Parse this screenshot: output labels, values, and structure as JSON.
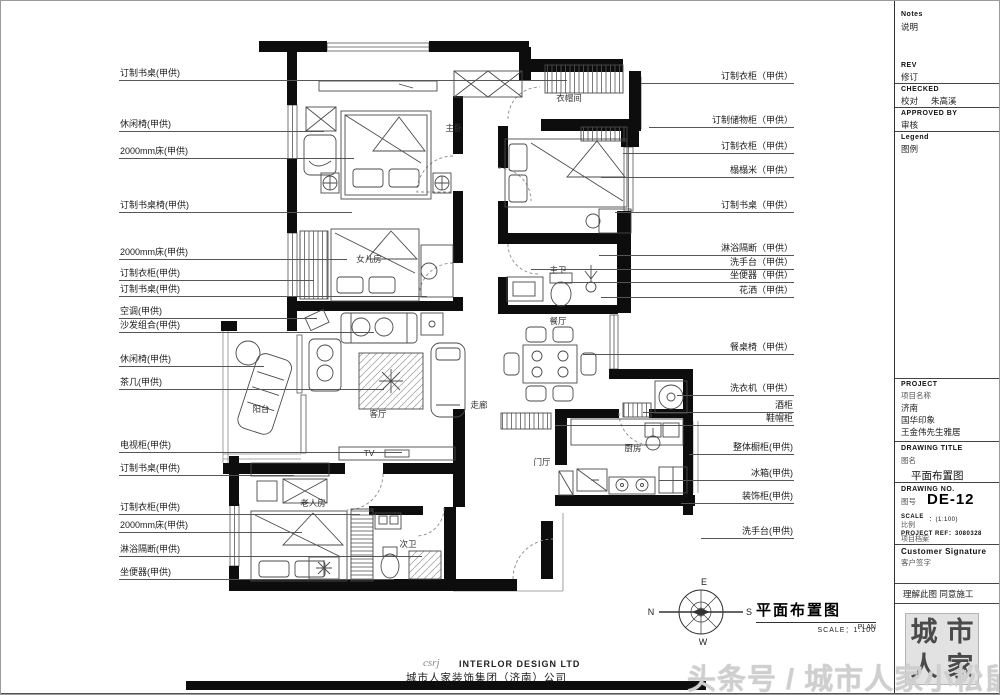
{
  "colors": {
    "wall": "#0d0d0d",
    "line": "#555555",
    "watermark": "#cfcfcf"
  },
  "annotations": {
    "left": [
      {
        "text": "订制书桌(甲供)",
        "x": 118,
        "x2": 565,
        "y": 78
      },
      {
        "text": "休闲椅(甲供)",
        "x": 118,
        "x2": 322,
        "y": 129
      },
      {
        "text": "2000mm床(甲供)",
        "x": 118,
        "x2": 352,
        "y": 156
      },
      {
        "text": "订制书桌椅(甲供)",
        "x": 118,
        "x2": 350,
        "y": 210
      },
      {
        "text": "2000mm床(甲供)",
        "x": 118,
        "x2": 345,
        "y": 257
      },
      {
        "text": "订制衣柜(甲供)",
        "x": 118,
        "x2": 312,
        "y": 278
      },
      {
        "text": "订制书桌(甲供)",
        "x": 118,
        "x2": 425,
        "y": 294
      },
      {
        "text": "空调(甲供)",
        "x": 118,
        "x2": 315,
        "y": 316
      },
      {
        "text": "沙发组合(甲供)",
        "x": 118,
        "x2": 372,
        "y": 330
      },
      {
        "text": "休闲椅(甲供)",
        "x": 118,
        "x2": 262,
        "y": 364
      },
      {
        "text": "茶几(甲供)",
        "x": 118,
        "x2": 382,
        "y": 387
      },
      {
        "text": "电视柜(甲供)",
        "x": 118,
        "x2": 400,
        "y": 450
      },
      {
        "text": "订制书桌(甲供)",
        "x": 118,
        "x2": 292,
        "y": 473
      },
      {
        "text": "订制衣柜(甲供)",
        "x": 118,
        "x2": 358,
        "y": 512
      },
      {
        "text": "2000mm床(甲供)",
        "x": 118,
        "x2": 300,
        "y": 530
      },
      {
        "text": "淋浴隔断(甲供)",
        "x": 118,
        "x2": 420,
        "y": 554
      },
      {
        "text": "坐便器(甲供)",
        "x": 118,
        "x2": 392,
        "y": 577
      }
    ],
    "right": [
      {
        "text": "订制衣柜（甲供）",
        "x": 640,
        "x2": 792,
        "y": 81
      },
      {
        "text": "订制储物柜（甲供）",
        "x": 648,
        "x2": 792,
        "y": 125
      },
      {
        "text": "订制衣柜（甲供）",
        "x": 622,
        "x2": 792,
        "y": 151
      },
      {
        "text": "榻榻米（甲供）",
        "x": 600,
        "x2": 792,
        "y": 175
      },
      {
        "text": "订制书桌（甲供）",
        "x": 614,
        "x2": 792,
        "y": 210
      },
      {
        "text": "淋浴隔断（甲供）",
        "x": 598,
        "x2": 792,
        "y": 253
      },
      {
        "text": "洗手台（甲供）",
        "x": 530,
        "x2": 792,
        "y": 267
      },
      {
        "text": "坐便器（甲供）",
        "x": 558,
        "x2": 792,
        "y": 280
      },
      {
        "text": "花洒（甲供）",
        "x": 600,
        "x2": 792,
        "y": 295
      },
      {
        "text": "餐桌椅（甲供）",
        "x": 582,
        "x2": 792,
        "y": 352
      },
      {
        "text": "洗衣机（甲供）",
        "x": 676,
        "x2": 792,
        "y": 393
      },
      {
        "text": "酒柜",
        "x": 642,
        "x2": 792,
        "y": 410
      },
      {
        "text": "鞋帽柜",
        "x": 554,
        "x2": 792,
        "y": 423
      },
      {
        "text": "整体橱柜(甲供)",
        "x": 688,
        "x2": 792,
        "y": 452
      },
      {
        "text": "冰箱(甲供)",
        "x": 658,
        "x2": 792,
        "y": 478
      },
      {
        "text": "装饰柜(甲供)",
        "x": 680,
        "x2": 792,
        "y": 501
      },
      {
        "text": "洗手台(甲供)",
        "x": 700,
        "x2": 792,
        "y": 536
      }
    ]
  },
  "plan": {
    "rooms": [
      {
        "label": "主卧",
        "x": 453,
        "y": 127
      },
      {
        "label": "衣帽间",
        "x": 568,
        "y": 97
      },
      {
        "label": "女儿房",
        "x": 368,
        "y": 258
      },
      {
        "label": "主卫",
        "x": 557,
        "y": 269
      },
      {
        "label": "餐厅",
        "x": 557,
        "y": 320
      },
      {
        "label": "走廊",
        "x": 478,
        "y": 404
      },
      {
        "label": "阳台",
        "x": 260,
        "y": 408
      },
      {
        "label": "客厅",
        "x": 377,
        "y": 413
      },
      {
        "label": "门厅",
        "x": 541,
        "y": 461
      },
      {
        "label": "厨房",
        "x": 632,
        "y": 447
      },
      {
        "label": "老人房",
        "x": 312,
        "y": 502
      },
      {
        "label": "次卫",
        "x": 407,
        "y": 543
      },
      {
        "label": "TV",
        "x": 368,
        "y": 452
      }
    ],
    "title": "平面布置图",
    "title_en": "PLAN",
    "scale_label": "SCALE：1:100",
    "compass": {
      "e": "E",
      "s": "S",
      "w": "W",
      "n": "N"
    }
  },
  "title_block": {
    "notes_en": "Notes",
    "notes_cn": "说明",
    "rev_en": "REV",
    "rev_cn": "修订",
    "checked_en": "CHECKED",
    "checked_cn": "校对",
    "checked_by": "朱高溪",
    "approved_en": "APPROVED BY",
    "approved_cn": "审核",
    "legend_en": "Legend",
    "legend_cn": "图例",
    "project_en": "PROJECT",
    "project_cn": "项目名称",
    "project_line1": "济南",
    "project_line2": "国华印象",
    "project_line3": "王金伟先生雅居",
    "drawing_title_en": "DRAWING TITLE",
    "drawing_title_cn": "图名",
    "drawing_title_value": "平面布置图",
    "drawing_no_en": "DRAWING NO.",
    "drawing_no_cn": "图号",
    "drawing_no_value": "DE-12",
    "scale_en": "SCALE",
    "scale_value": "：(1:100)",
    "scale_cn": "比例",
    "ref_en": "PROJECT REF：3080328",
    "ref_cn": "项目档案",
    "signature_en": "Customer Signature",
    "signature_cn": "客户签字",
    "note_line": "理解此图 同意施工",
    "stamp_chars": [
      "城",
      "市",
      "人",
      "家"
    ]
  },
  "footer": {
    "logo": "csrj",
    "company_en": "INTERLOR DESIGN LTD",
    "company_cn": "城市人家装饰集团（济南）公司"
  },
  "watermark": "头条号 / 城市人家小松鼠"
}
